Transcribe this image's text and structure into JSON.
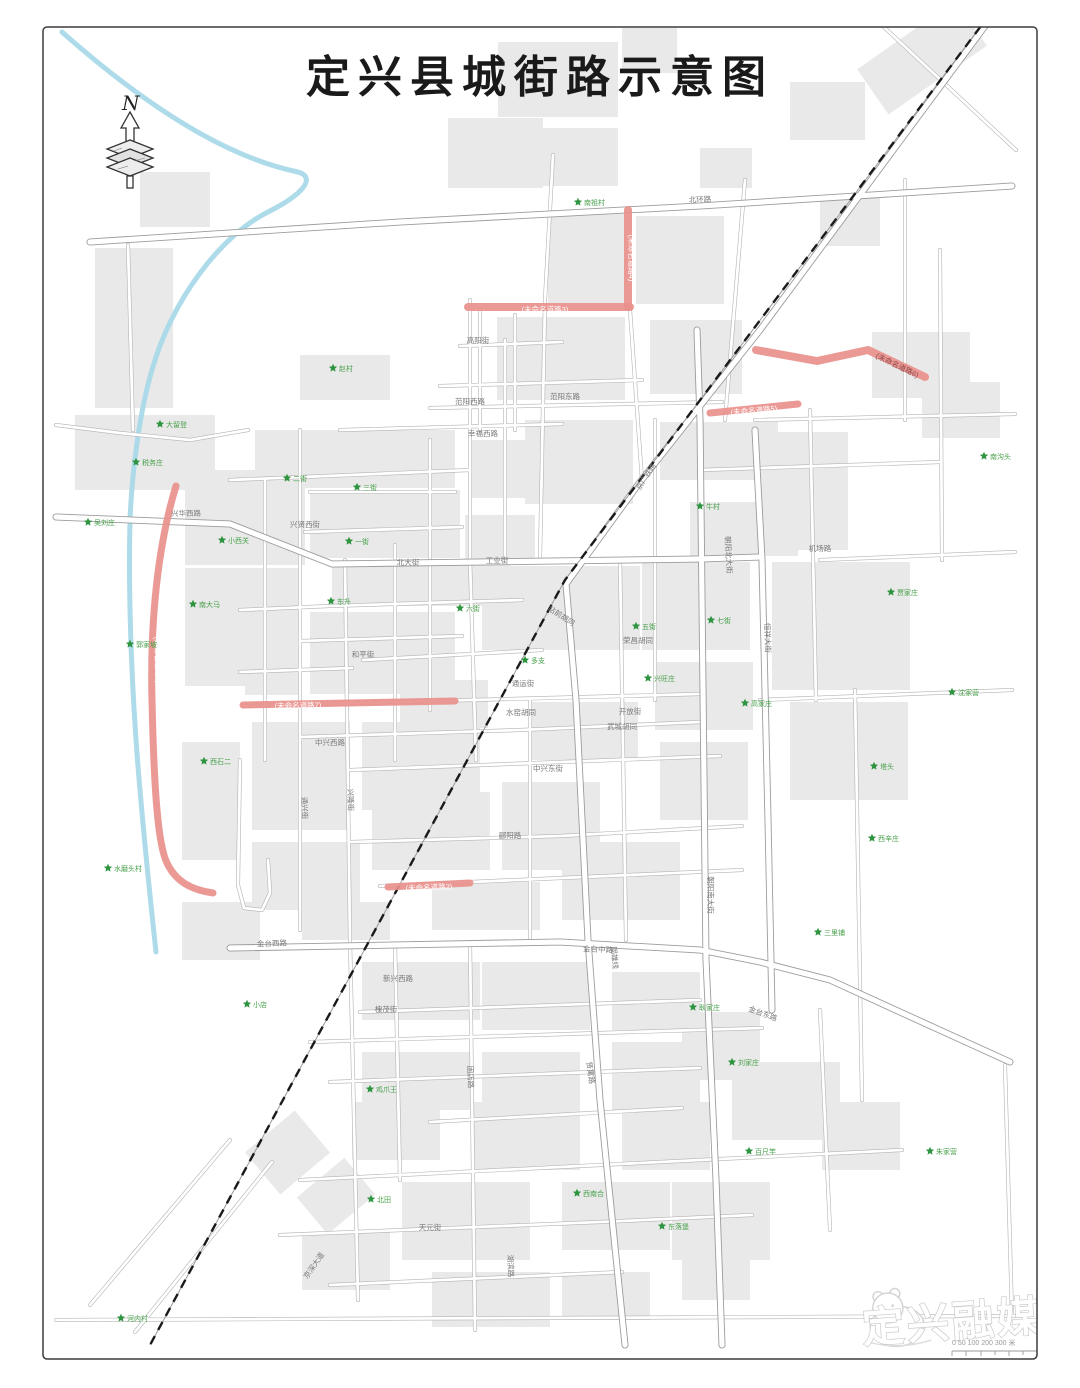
{
  "page": {
    "title": "定兴县城街路示意图"
  },
  "north_label": "N",
  "colors": {
    "highlight": "#e9908c",
    "river": "#a9d9e9",
    "building": "#e9e9e9",
    "railway": "#1a1a1a",
    "road_casing": "#b3b3b3",
    "road_fill": "#ffffff",
    "road_label": "#7a7a7a",
    "village": "#2e9440",
    "village_label": "#46a049"
  },
  "unnamed_roads": [
    {
      "id": 1,
      "label": "(未命名道路1)",
      "d": "M176,486 C158,545 150,620 152,700 C154,790 158,845 167,863 C176,882 192,890 213,893",
      "w": 7,
      "lx": 157,
      "ly": 660,
      "lr": 88,
      "lc": "#ffffff"
    },
    {
      "id": 2,
      "label": "(未命名道路2)",
      "d": "M388,887 L470,883",
      "w": 7,
      "lx": 429,
      "ly": 888,
      "lr": -2,
      "lc": "#ffffff"
    },
    {
      "id": 3,
      "label": "(未命名道路3)",
      "d": "M468,307 L630,307",
      "w": 8,
      "lx": 545,
      "ly": 310,
      "lr": 0,
      "lc": "#ffffff"
    },
    {
      "id": 4,
      "label": "(未命名道路4)",
      "d": "M628,210 L628,307",
      "w": 8,
      "lx": 631,
      "ly": 258,
      "lr": 90,
      "lc": "#ffffff"
    },
    {
      "id": 5,
      "label": "(未命名道路5)",
      "d": "M710,413 L798,404",
      "w": 7,
      "lx": 754,
      "ly": 411,
      "lr": -5,
      "lc": "#ffffff"
    },
    {
      "id": 6,
      "label": "(未命名道路6)",
      "d": "M756,350 L817,361 L868,350 L925,377",
      "w": 8,
      "lx": 897,
      "ly": 366,
      "lr": 26,
      "lc": "#8f4a4a"
    },
    {
      "id": 7,
      "label": "(未命名道路7)",
      "d": "M243,705 L455,701",
      "w": 7,
      "lx": 298,
      "ly": 706,
      "lr": -1,
      "lc": "#ffffff"
    }
  ],
  "road_labels": [
    {
      "t": "北环路",
      "x": 700,
      "y": 202,
      "r": -2
    },
    {
      "t": "兴华西路",
      "x": 186,
      "y": 516,
      "r": -1
    },
    {
      "t": "兴贤西街",
      "x": 305,
      "y": 527,
      "r": 0
    },
    {
      "t": "范阳西路",
      "x": 470,
      "y": 404,
      "r": 0
    },
    {
      "t": "范阳东路",
      "x": 565,
      "y": 399,
      "r": 0
    },
    {
      "t": "幸福西路",
      "x": 483,
      "y": 436,
      "r": 0
    },
    {
      "t": "高阳街",
      "x": 478,
      "y": 343,
      "r": 0
    },
    {
      "t": "北大街",
      "x": 408,
      "y": 565,
      "r": 0
    },
    {
      "t": "工业街",
      "x": 497,
      "y": 563,
      "r": 0
    },
    {
      "t": "站前胡同",
      "x": 560,
      "y": 618,
      "r": 33
    },
    {
      "t": "和平街",
      "x": 363,
      "y": 657,
      "r": 0
    },
    {
      "t": "通运街",
      "x": 523,
      "y": 686,
      "r": 0
    },
    {
      "t": "水窑胡同",
      "x": 521,
      "y": 715,
      "r": 0
    },
    {
      "t": "开放街",
      "x": 630,
      "y": 714,
      "r": 0
    },
    {
      "t": "武城胡同",
      "x": 622,
      "y": 729,
      "r": 0
    },
    {
      "t": "荣昌胡同",
      "x": 638,
      "y": 643,
      "r": 0
    },
    {
      "t": "中兴西路",
      "x": 330,
      "y": 745,
      "r": 0
    },
    {
      "t": "中兴东街",
      "x": 548,
      "y": 771,
      "r": 0
    },
    {
      "t": "郦阳路",
      "x": 510,
      "y": 838,
      "r": 0
    },
    {
      "t": "金台西路",
      "x": 272,
      "y": 946,
      "r": -2
    },
    {
      "t": "金台中路",
      "x": 598,
      "y": 952,
      "r": 2
    },
    {
      "t": "金台东路",
      "x": 762,
      "y": 1016,
      "r": 20
    },
    {
      "t": "朝阳南大街",
      "x": 708,
      "y": 895,
      "r": 90
    },
    {
      "t": "朝阳北大街",
      "x": 726,
      "y": 555,
      "r": 87
    },
    {
      "t": "恒祥大街",
      "x": 765,
      "y": 638,
      "r": 88
    },
    {
      "t": "固雄线",
      "x": 612,
      "y": 958,
      "r": 84
    },
    {
      "t": "兴隆街",
      "x": 348,
      "y": 800,
      "r": 88
    },
    {
      "t": "通兴街",
      "x": 302,
      "y": 808,
      "r": 88
    },
    {
      "t": "槐茂街",
      "x": 386,
      "y": 1012,
      "r": 0
    },
    {
      "t": "新兴西路",
      "x": 398,
      "y": 981,
      "r": 0
    },
    {
      "t": "固店路",
      "x": 468,
      "y": 1077,
      "r": 88
    },
    {
      "t": "贤寓路",
      "x": 588,
      "y": 1073,
      "r": 82
    },
    {
      "t": "机场路",
      "x": 820,
      "y": 551,
      "r": 0
    },
    {
      "t": "天元街",
      "x": 430,
      "y": 1230,
      "r": 0
    },
    {
      "t": "湖滨路",
      "x": 508,
      "y": 1266,
      "r": 88
    },
    {
      "t": "京深大道",
      "x": 316,
      "y": 1267,
      "r": -55
    },
    {
      "t": "京广铁路",
      "x": 648,
      "y": 478,
      "r": -57
    }
  ],
  "villages": [
    {
      "n": "南祖村",
      "x": 578,
      "y": 202
    },
    {
      "n": "赵村",
      "x": 333,
      "y": 368
    },
    {
      "n": "大留登",
      "x": 160,
      "y": 424
    },
    {
      "n": "税务庄",
      "x": 136,
      "y": 462
    },
    {
      "n": "吴刘庄",
      "x": 88,
      "y": 522
    },
    {
      "n": "小西关",
      "x": 222,
      "y": 540
    },
    {
      "n": "二街",
      "x": 287,
      "y": 478
    },
    {
      "n": "三街",
      "x": 357,
      "y": 487
    },
    {
      "n": "一街",
      "x": 349,
      "y": 541
    },
    {
      "n": "南大马",
      "x": 193,
      "y": 604
    },
    {
      "n": "郭家坡",
      "x": 130,
      "y": 644
    },
    {
      "n": "东升",
      "x": 331,
      "y": 601
    },
    {
      "n": "六街",
      "x": 460,
      "y": 608
    },
    {
      "n": "多支",
      "x": 525,
      "y": 660
    },
    {
      "n": "五街",
      "x": 636,
      "y": 626
    },
    {
      "n": "牛村",
      "x": 700,
      "y": 506
    },
    {
      "n": "七街",
      "x": 711,
      "y": 620
    },
    {
      "n": "兴旺庄",
      "x": 648,
      "y": 678
    },
    {
      "n": "高家庄",
      "x": 745,
      "y": 703
    },
    {
      "n": "沈家营",
      "x": 952,
      "y": 692
    },
    {
      "n": "南沟头",
      "x": 984,
      "y": 456
    },
    {
      "n": "贾家庄",
      "x": 891,
      "y": 592
    },
    {
      "n": "塔头",
      "x": 874,
      "y": 766
    },
    {
      "n": "西辛庄",
      "x": 872,
      "y": 838
    },
    {
      "n": "三里铺",
      "x": 818,
      "y": 932
    },
    {
      "n": "耿家庄",
      "x": 693,
      "y": 1007
    },
    {
      "n": "刘家庄",
      "x": 732,
      "y": 1062
    },
    {
      "n": "鸡爪王",
      "x": 370,
      "y": 1089
    },
    {
      "n": "小店",
      "x": 247,
      "y": 1004
    },
    {
      "n": "北田",
      "x": 371,
      "y": 1199
    },
    {
      "n": "西南合",
      "x": 577,
      "y": 1193
    },
    {
      "n": "东落堡",
      "x": 662,
      "y": 1226
    },
    {
      "n": "百尺竿",
      "x": 749,
      "y": 1151
    },
    {
      "n": "朱家营",
      "x": 930,
      "y": 1151
    },
    {
      "n": "河内村",
      "x": 121,
      "y": 1318
    },
    {
      "n": "水磨头村",
      "x": 108,
      "y": 868
    },
    {
      "n": "西石二",
      "x": 204,
      "y": 761
    }
  ],
  "watermark": {
    "brand": "定兴融媒"
  },
  "scalebar": {
    "label": "0 50 100     200     300 米"
  }
}
